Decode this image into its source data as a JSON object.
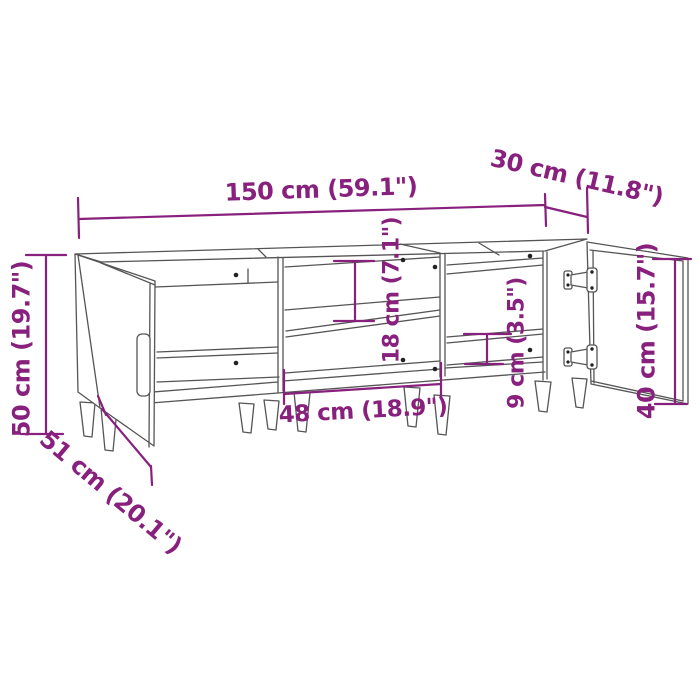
{
  "page": {
    "background": "#ffffff",
    "description": "Technical dimension drawing of a TV cabinet with two open doors, open middle compartment with shelf, and tapered legs"
  },
  "drawing": {
    "line_color": "#555555",
    "dimension_color": "#88207D",
    "pin_color": "#222222"
  },
  "dimensions": {
    "width": {
      "cm": 150,
      "inch": "59.1",
      "label": "150 cm (59.1\")"
    },
    "depth": {
      "cm": 30,
      "inch": "11.8",
      "label": "30 cm (11.8\")"
    },
    "height": {
      "cm": 50,
      "inch": "19.7",
      "label": "50 cm (19.7\")"
    },
    "depth_door_open": {
      "cm": 51,
      "inch": "20.1",
      "label": "51 cm (20.1\")"
    },
    "compartment_width": {
      "cm": 48,
      "inch": "18.9",
      "label": "48 cm (18.9\")"
    },
    "compartment_height": {
      "cm": 18,
      "inch": "7.1",
      "label": "18 cm (7.1\")"
    },
    "shelf_spacing": {
      "cm": 9,
      "inch": "3.5",
      "label": "9 cm (3.5\")"
    },
    "door_height": {
      "cm": 40,
      "inch": "15.7",
      "label": "40 cm (15.7\")"
    }
  }
}
